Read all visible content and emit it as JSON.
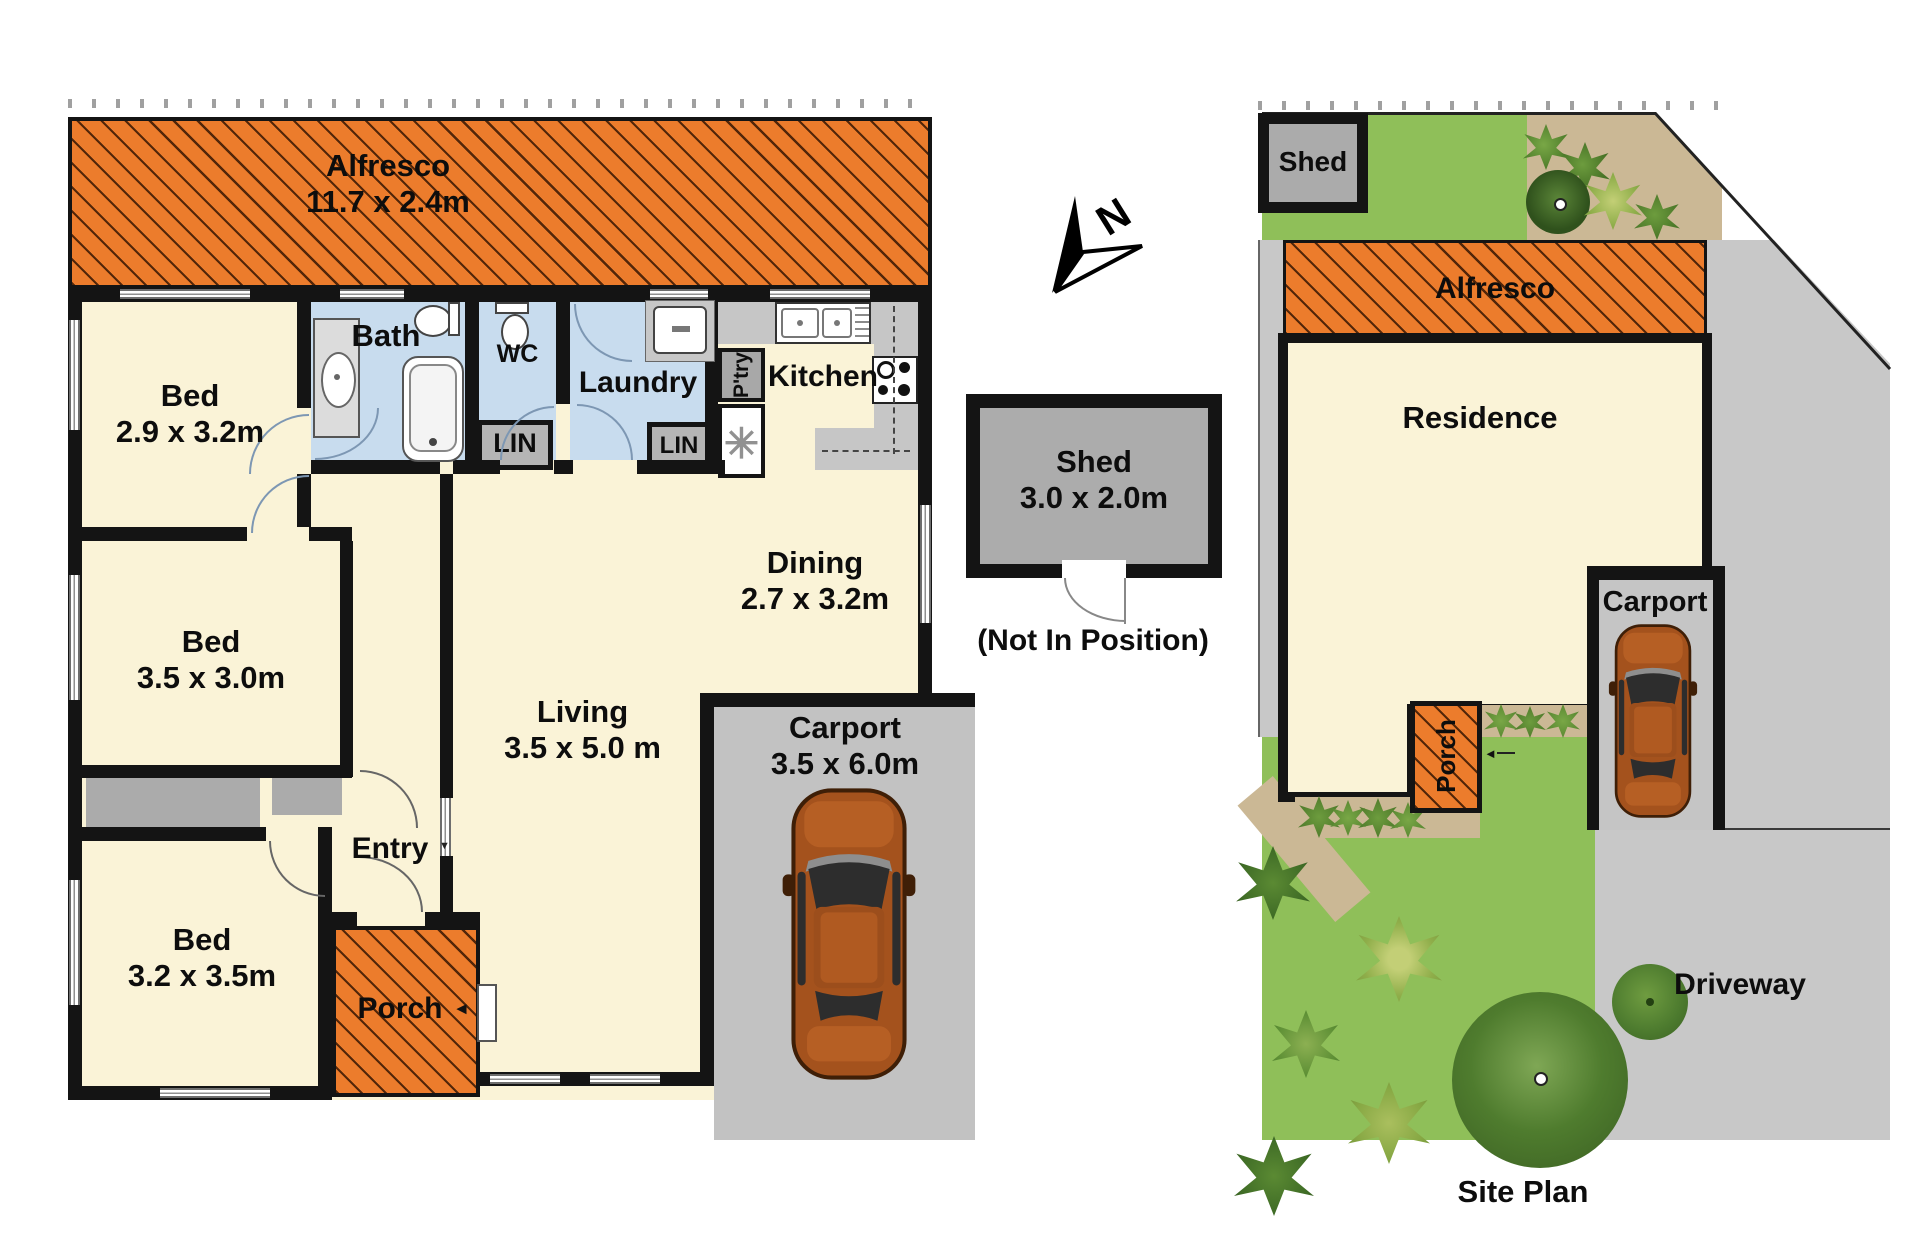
{
  "floor_plan": {
    "alfresco": {
      "name": "Alfresco",
      "dims": "11.7 x 2.4m"
    },
    "bed1": {
      "name": "Bed",
      "dims": "2.9 x 3.2m"
    },
    "bath": {
      "name": "Bath"
    },
    "wc": {
      "name": "WC"
    },
    "laundry": {
      "name": "Laundry"
    },
    "linen1": {
      "name": "LIN"
    },
    "linen2": {
      "name": "LIN"
    },
    "pantry": {
      "name": "P'try"
    },
    "kitchen": {
      "name": "Kitchen"
    },
    "dining": {
      "name": "Dining",
      "dims": "2.7 x 3.2m"
    },
    "living": {
      "name": "Living",
      "dims": "3.5 x 5.0 m"
    },
    "entry": {
      "name": "Entry"
    },
    "bed2": {
      "name": "Bed",
      "dims": "3.5 x 3.0m"
    },
    "bed3": {
      "name": "Bed",
      "dims": "3.2 x 3.5m"
    },
    "porch": {
      "name": "Porch"
    },
    "carport": {
      "name": "Carport",
      "dims": "3.5 x 6.0m"
    },
    "hot_water_symbol": "✳",
    "porch_arrow": "◄",
    "entry_arrow": "▼"
  },
  "compass": {
    "label": "N"
  },
  "shed_detail": {
    "name": "Shed",
    "dims": "3.0 x 2.0m",
    "note": "(Not In Position)"
  },
  "site_plan": {
    "title": "Site Plan",
    "shed_label": "Shed",
    "alfresco_label": "Alfresco",
    "residence_label": "Residence",
    "carport_label": "Carport",
    "porch_label": "Porch",
    "driveway_label": "Driveway",
    "porch_arrow": "◄"
  },
  "colors": {
    "alfresco_orange": "#EC7C2C",
    "room_cream": "#FAF3D7",
    "wet_area_blue": "#C8DCEE",
    "wall_black": "#141414",
    "grass_green": "#8FBF59",
    "garden_tan": "#CBB895",
    "paving_gray": "#C8C8C8",
    "car_brown": "#A4521D"
  }
}
